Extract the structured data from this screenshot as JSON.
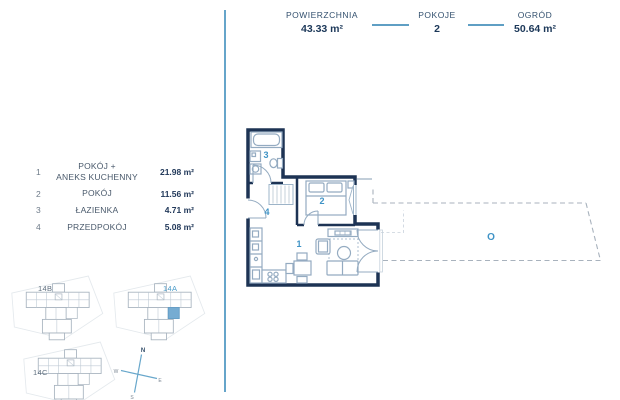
{
  "header": {
    "stats": [
      {
        "label": "POWIERZCHNIA",
        "value": "43.33 m²"
      },
      {
        "label": "POKOJE",
        "value": "2"
      },
      {
        "label": "OGRÓD",
        "value": "50.64 m²"
      }
    ]
  },
  "legend": {
    "rooms": [
      {
        "num": "1",
        "name": "POKÓJ +\nANEKS KUCHENNY",
        "area": "21.98 m²"
      },
      {
        "num": "2",
        "name": "POKÓJ",
        "area": "11.56 m²"
      },
      {
        "num": "3",
        "name": "ŁAZIENKA",
        "area": "4.71 m²"
      },
      {
        "num": "4",
        "name": "PRZEDPOKÓJ",
        "area": "5.08 m²"
      }
    ]
  },
  "plan": {
    "labels": {
      "room1": "1",
      "room2": "2",
      "room3": "3",
      "room4": "4",
      "garden": "O"
    }
  },
  "minimap": {
    "buildings": [
      {
        "label": "14B",
        "selected": false
      },
      {
        "label": "14A",
        "selected": true
      },
      {
        "label": "14C",
        "selected": false
      }
    ]
  },
  "compass": {
    "north": "N",
    "east": "E",
    "south": "S",
    "west": "W"
  },
  "colors": {
    "accent_blue": "#3f93c6",
    "navy_text": "#1c3859",
    "light_blue_line": "#66a5ca",
    "wall": "#1d3354",
    "furniture": "#94abc1",
    "selected_unit": "#76acd2",
    "garden_dash": "#a8b2bd"
  }
}
